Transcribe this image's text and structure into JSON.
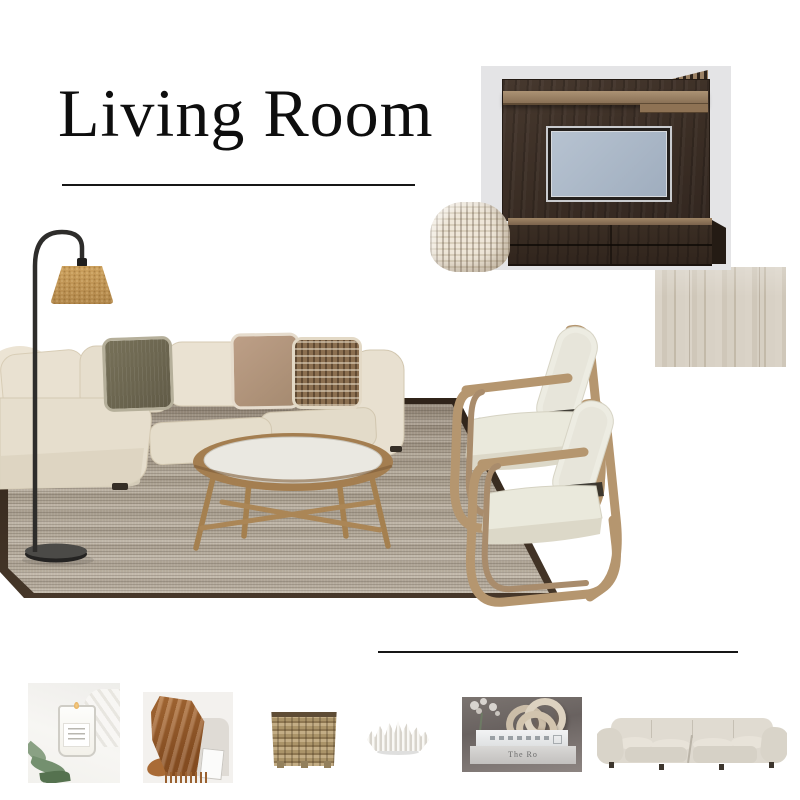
{
  "board": {
    "title": "Living Room",
    "background_color": "#ffffff",
    "divider_line_count": 2
  },
  "items": {
    "tv_unit": {
      "label": "Dark walnut TV wall unit with slat detail",
      "panel_color": "#3a2d24",
      "screen_color": "#aab8c6",
      "backdrop_color": "#e4e4e6"
    },
    "pouf": {
      "label": "Cream woven rope pouf",
      "color": "#e9e1d3"
    },
    "floor_sample": {
      "label": "Light oak flooring swatch",
      "color": "#d5cec2"
    },
    "floor_lamp": {
      "label": "Black arc floor lamp with cork shade",
      "shade_color": "#c49a5e",
      "stand_color": "#2e2d2b"
    },
    "sofa": {
      "label": "Beige linen modular sectional sofa",
      "color": "#e6decd"
    },
    "pillows": [
      {
        "label": "Olive textured cushion",
        "color": "#6e6853"
      },
      {
        "label": "Taupe linen cushion",
        "color": "#b29379"
      },
      {
        "label": "Woven check cushion",
        "color": "#8b6f50"
      }
    ],
    "rug": {
      "label": "Striated jute rug with dark border",
      "color": "#b5ab9c",
      "border_color": "#3a2c21"
    },
    "coffee_table": {
      "label": "Oval oak coffee table with white top",
      "wood_color": "#a47e50",
      "top_color": "#eae8e1"
    },
    "armchairs": {
      "label": "Pair of oak-frame accent armchairs",
      "frame_color": "#b5966f",
      "cushion_color": "#ecebe0"
    }
  },
  "thumbnails": [
    {
      "id": "candle",
      "label": "Scented candle in glass jar"
    },
    {
      "id": "throw",
      "label": "Rust knitted throw blanket"
    },
    {
      "id": "basket",
      "label": "Woven wicker basket planter"
    },
    {
      "id": "coral",
      "label": "White coral bowl sculpture"
    },
    {
      "id": "books",
      "label": "Coffee table books with knot decor",
      "spine_text": "The Ro"
    },
    {
      "id": "sectional",
      "label": "Cream fabric corner sofa"
    }
  ],
  "colors": {
    "title_text": "#0e0e0e",
    "rule": "#161616",
    "page_background": "#ffffff"
  }
}
